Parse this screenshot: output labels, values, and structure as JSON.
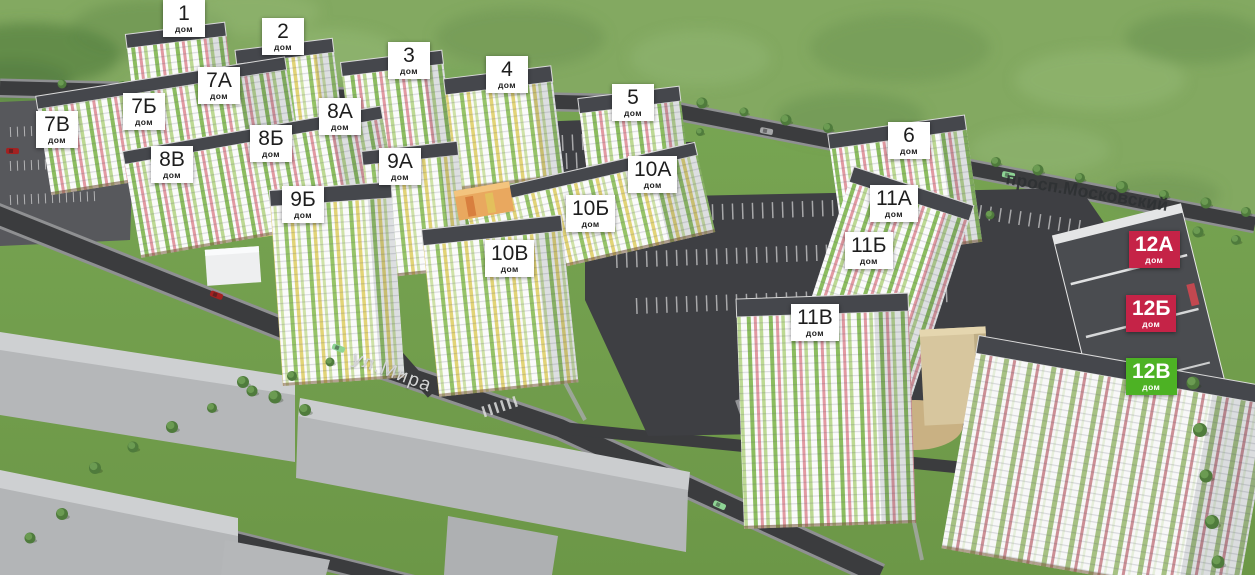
{
  "streets": {
    "prospekt": {
      "name": "просп.Московский"
    },
    "mira": {
      "name": "ул.Мира"
    }
  },
  "buildings": [
    {
      "number": "1",
      "unit": "дом",
      "x": 163,
      "y": 0,
      "variant": "white"
    },
    {
      "number": "2",
      "unit": "дом",
      "x": 262,
      "y": 18,
      "variant": "white"
    },
    {
      "number": "3",
      "unit": "дом",
      "x": 388,
      "y": 42,
      "variant": "white"
    },
    {
      "number": "4",
      "unit": "дом",
      "x": 486,
      "y": 56,
      "variant": "white"
    },
    {
      "number": "5",
      "unit": "дом",
      "x": 612,
      "y": 84,
      "variant": "white"
    },
    {
      "number": "6",
      "unit": "дом",
      "x": 888,
      "y": 122,
      "variant": "white"
    },
    {
      "number": "7А",
      "unit": "дом",
      "x": 198,
      "y": 67,
      "variant": "white"
    },
    {
      "number": "7Б",
      "unit": "дом",
      "x": 123,
      "y": 93,
      "variant": "white"
    },
    {
      "number": "7В",
      "unit": "дом",
      "x": 36,
      "y": 111,
      "variant": "white"
    },
    {
      "number": "8А",
      "unit": "дом",
      "x": 319,
      "y": 98,
      "variant": "white"
    },
    {
      "number": "8Б",
      "unit": "дом",
      "x": 250,
      "y": 125,
      "variant": "white"
    },
    {
      "number": "8В",
      "unit": "дом",
      "x": 151,
      "y": 146,
      "variant": "white"
    },
    {
      "number": "9А",
      "unit": "дом",
      "x": 379,
      "y": 148,
      "variant": "white"
    },
    {
      "number": "9Б",
      "unit": "дом",
      "x": 282,
      "y": 186,
      "variant": "white"
    },
    {
      "number": "10А",
      "unit": "дом",
      "x": 628,
      "y": 156,
      "variant": "white"
    },
    {
      "number": "10Б",
      "unit": "дом",
      "x": 566,
      "y": 195,
      "variant": "white"
    },
    {
      "number": "10В",
      "unit": "дом",
      "x": 485,
      "y": 240,
      "variant": "white"
    },
    {
      "number": "11А",
      "unit": "дом",
      "x": 870,
      "y": 185,
      "variant": "white"
    },
    {
      "number": "11Б",
      "unit": "дом",
      "x": 845,
      "y": 232,
      "variant": "white"
    },
    {
      "number": "11В",
      "unit": "дом",
      "x": 791,
      "y": 304,
      "variant": "white"
    },
    {
      "number": "12А",
      "unit": "дом",
      "x": 1129,
      "y": 231,
      "variant": "red"
    },
    {
      "number": "12Б",
      "unit": "дом",
      "x": 1126,
      "y": 295,
      "variant": "red"
    },
    {
      "number": "12В",
      "unit": "дом",
      "x": 1126,
      "y": 358,
      "variant": "green"
    }
  ],
  "colors": {
    "label_white_bg": "#ffffff",
    "label_text_dark": "#1d1d1d",
    "label_red_bg": "#c52347",
    "label_green_bg": "#4db224",
    "label_text_light": "#ffffff",
    "street_text_dark": "#2e3133",
    "street_text_light": "#d4d5d6"
  },
  "cars": [
    {
      "x": 210,
      "y": 292,
      "rot": 21,
      "color": "#a32121"
    },
    {
      "x": 332,
      "y": 345,
      "rot": 21,
      "color": "#8ed495"
    },
    {
      "x": 713,
      "y": 502,
      "rot": 24,
      "color": "#8ed495"
    },
    {
      "x": 6,
      "y": 148,
      "rot": 2,
      "color": "#a32121"
    },
    {
      "x": 1002,
      "y": 172,
      "rot": 11,
      "color": "#8ed495"
    },
    {
      "x": 760,
      "y": 128,
      "rot": 11,
      "color": "#a6a7a9"
    }
  ]
}
